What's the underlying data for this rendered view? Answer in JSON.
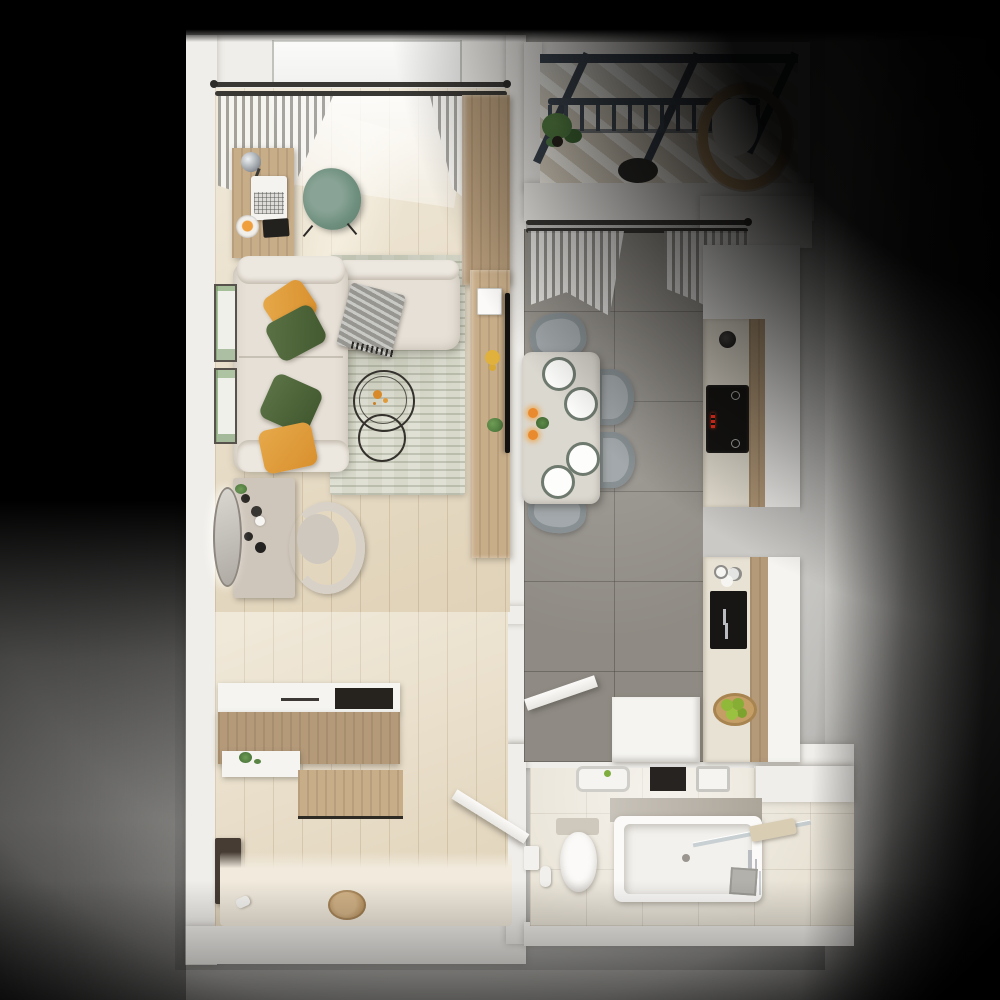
{
  "scene": {
    "type": "3d-floorplan-top-view-render",
    "view": "top-down orthographic",
    "style": "photorealistic architectural visualization of a one-bedroom apartment",
    "lighting": "studio spotlight from upper-left; soft ground glow around unit; long shadow cast to the right; black vignette corners",
    "visible_text": "none"
  },
  "palette": {
    "bg": "#000000",
    "ground": "#d7d6d4",
    "wall": "#f0eeea",
    "wood-floor": "#e8dcc4",
    "wood-dark": "#b49a79",
    "wood-mid": "#c8ad89",
    "kitchen-floor": "#8f8b84",
    "bath-floor": "#e9e3d6",
    "rug": "#d8d9ca",
    "sofa": "#e6e0d7",
    "pillow-orange": "#d9902e",
    "pillow-green": "#42582f",
    "chair-green": "#70907f",
    "chair-gray": "#a2a8ab",
    "table-top": "#dbd8d0",
    "counter": "#e8e2d4",
    "appliance-black": "#161513",
    "led-red": "#ff3420",
    "glass-frame": "#3c4550",
    "plant-green": "#4e7a40",
    "fruit-green": "#90b93a",
    "wicker": "#c9a26e",
    "cream": "#f1eadd",
    "chrome": "#b9bdc1"
  },
  "rooms": {
    "living_room": {
      "label": "Living room / study",
      "floor": "light oak plank",
      "items": [
        "double curtain rod with sheer curtains",
        "window",
        "work desk with chrome lamp, laptop, goldfish bowl, notebook",
        "green swivel desk chair",
        "tall wood wardrobe",
        "L-shaped beige corner sofa",
        "2 orange accent pillows",
        "2 green accent pillows",
        "gray knit throw",
        "textured gray-green area rug",
        "2 nesting round wire coffee tables",
        "wood media console with decor",
        "wall-mounted TV",
        "vanity table with perfumes",
        "round wall mirror",
        "upholstered vanity chair",
        "2 botanical wall prints"
      ]
    },
    "balcony": {
      "label": "Balcony",
      "floor": "light decking with sun stripes",
      "items": [
        "glass roof with dark metal beams",
        "metal railing with balusters",
        "potted plant",
        "round wicker chair with white cushion",
        "small dark side table"
      ]
    },
    "kitchen_dining": {
      "label": "Kitchen / dining room",
      "floor": "large gray marble tile",
      "items": [
        "double curtain rod with gray curtains",
        "dining table with 4 place settings",
        "4 white plates",
        "2 candles",
        "small centerpiece plant",
        "4 gray upholstered chairs",
        "white cabinet run",
        "beige countertop",
        "black kettle",
        "black induction cooktop with red LED display",
        "tall wood cabinet panels",
        "black sink niche with chrome faucet",
        "glass cluster",
        "wood bowl with green apples",
        "white utility block",
        "open white door"
      ]
    },
    "bathroom": {
      "label": "Bathroom",
      "floor": "beige stone tile",
      "items": [
        "white wall-hung sink with green soap",
        "dark towel niche",
        "washing machine",
        "toilet with cistern",
        "toilet-paper holder with spare roll",
        "bathtub with marble deck",
        "glass bath screen",
        "beige towel on screen",
        "chrome bath faucet",
        "gray bath mat"
      ]
    },
    "hallway_entry": {
      "label": "Hallway / entry",
      "floor": "light oak plank with cream entry mat",
      "items": [
        "shoe cabinet with white top and dark tray",
        "wood wall panel",
        "white shelf with green plant",
        "dark wall bench",
        "round wood floor medallion",
        "open white interior door",
        "white slippers"
      ]
    }
  }
}
